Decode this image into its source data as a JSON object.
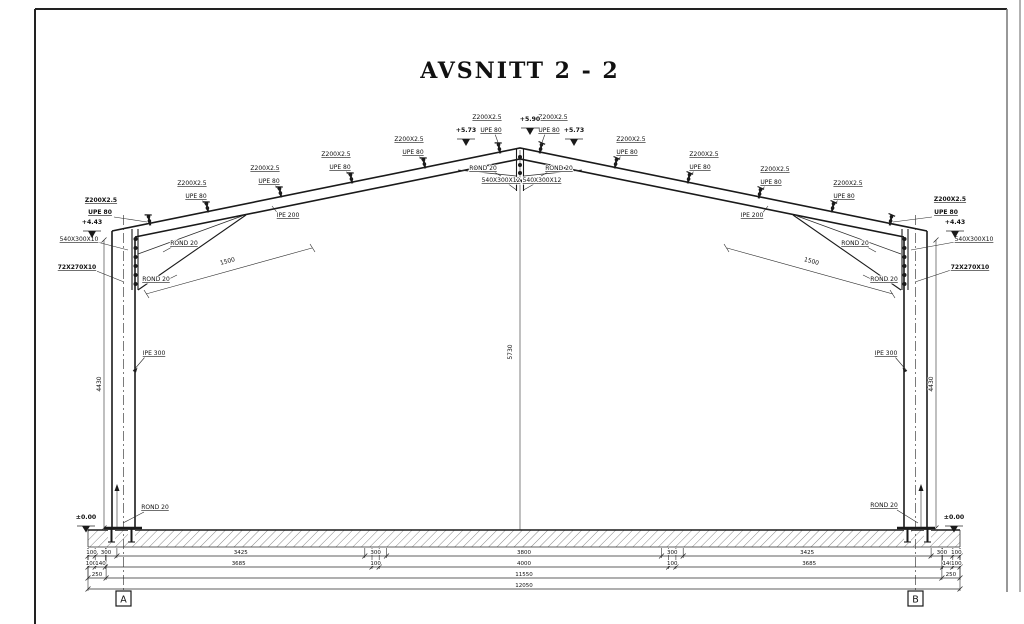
{
  "title": "AVSNITT 2 - 2",
  "frame": {
    "purlin": "Z200X2.5",
    "purlin_channel": "UPE 80",
    "rafter": "IPE 200",
    "column": "IPE 300",
    "rod": "ROND 20",
    "apex_plate": "540X300X12",
    "eave_plate": "540X300X10",
    "eave_stiffener": "72X270X10",
    "haunch_length": "1500"
  },
  "levels": {
    "ridge_top": "+5.90",
    "ridge": "+5.73",
    "eave": "+4.43",
    "base": "±0.00"
  },
  "dims": {
    "height_column": "4430",
    "height_ridge": "5730",
    "row1": [
      "100",
      "300",
      "3425",
      "300",
      "3800",
      "300",
      "3425",
      "300",
      "100"
    ],
    "row2": [
      "100",
      "140",
      "3685",
      "100",
      "4000",
      "100",
      "3685",
      "140",
      "100"
    ],
    "row3": [
      "250",
      "11550",
      "250"
    ],
    "total": "12050"
  },
  "grid": {
    "left": "A",
    "right": "B"
  }
}
